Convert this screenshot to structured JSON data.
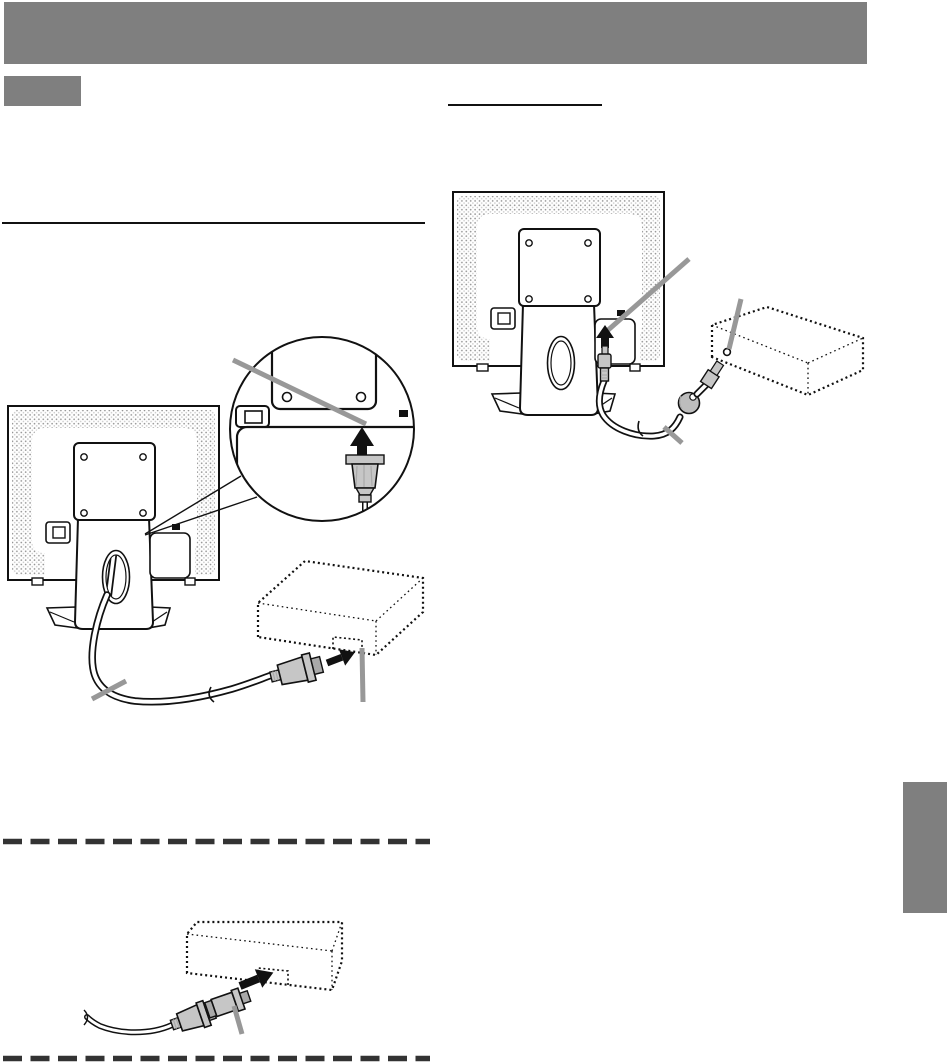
{
  "page": {
    "kind": "monitor-manual-page",
    "visible_text": ""
  },
  "colors": {
    "page-bg": "#ffffff",
    "header-bar": "#7f7f7f",
    "section-marker": "#7f7f7f",
    "side-tab": "#7f7f7f",
    "rule": "#111111",
    "dashed-divider": "#333333",
    "ink": "#111111",
    "callout-line": "#989898",
    "connector-fill": "#c6c6c6",
    "connector-dark": "#a9a9a9",
    "ferrite-fill": "#bdbdbd",
    "stipple-dot": "#8f8f8f",
    "stipple-dot-light": "#c9c9c9"
  },
  "artwork": {
    "figures": [
      {
        "id": "figure-analog-connection",
        "elements": [
          "monitor-rear-view",
          "magnifier-circle",
          "insert-arrow",
          "signal-connector",
          "signal-cable",
          "cable-tie-mark",
          "computer-dotted-box",
          "terminal-notch",
          "callout-line-magnified-terminal",
          "callout-line-cable",
          "callout-line-computer-terminal"
        ]
      },
      {
        "id": "figure-audio-connection",
        "elements": [
          "monitor-rear-view",
          "insert-arrow",
          "audio-plug",
          "audio-cable",
          "ferrite-core",
          "computer-end-plug",
          "computer-dotted-box",
          "audio-output-terminal",
          "callout-line-audio-terminal",
          "callout-line-computer-audio-terminal",
          "callout-line-audio-cable"
        ]
      },
      {
        "id": "figure-adapter-connection",
        "elements": [
          "computer-dotted-box",
          "terminal-notch",
          "insert-arrow",
          "adapter",
          "signal-connector",
          "signal-cable",
          "callout-line-adapter"
        ]
      }
    ]
  }
}
